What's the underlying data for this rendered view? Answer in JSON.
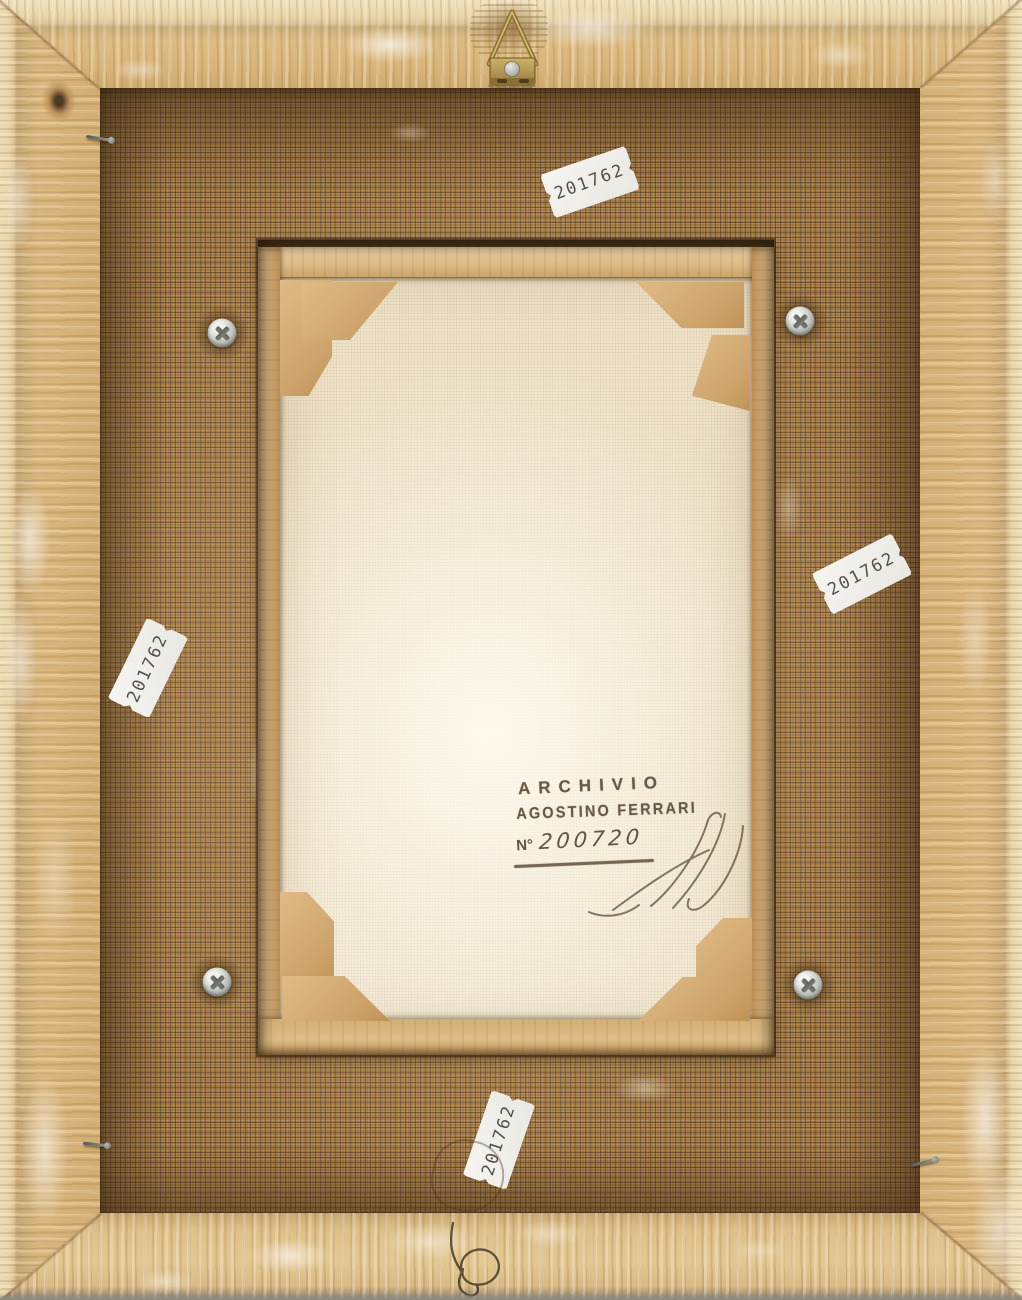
{
  "inventory_labels": [
    {
      "value": "201762"
    },
    {
      "value": "201762"
    },
    {
      "value": "201762"
    },
    {
      "value": "201762"
    }
  ],
  "archive_stamp": {
    "line1": "ARCHIVIO",
    "line2": "AGOSTINO FERRARI",
    "number_prefix": "N°",
    "number": "200720"
  },
  "colors": {
    "frame_wood": "#d8b67e",
    "backing_board": "#a8804d",
    "canvas": "#f2e9d4",
    "label_background": "#f4f3ef",
    "label_text": "#52504e",
    "stamp_ink": "#64523e",
    "hanger_brass": "#a08544",
    "screw_metal": "#c7cac3"
  }
}
